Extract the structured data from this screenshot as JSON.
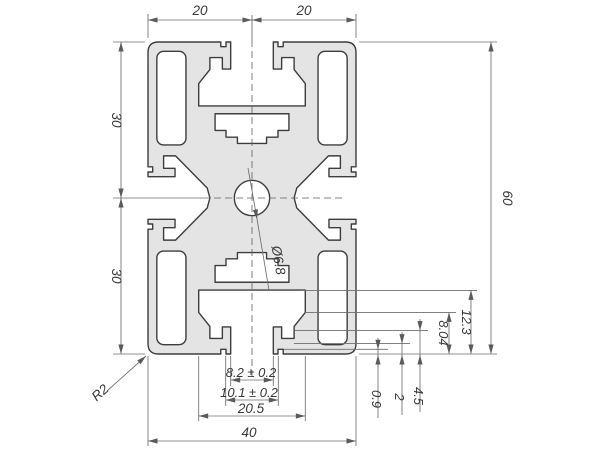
{
  "drawing": {
    "title": "Aluminium extrusion profile 40x60 cross-section, dimensioned technical drawing",
    "dims": {
      "top_left": "20",
      "top_right": "20",
      "left_upper": "30",
      "left_lower": "30",
      "height": "60",
      "stack_outer": "12.3",
      "stack_inner": "8.04",
      "lip_a": "4.5",
      "lip_b": "2",
      "lip_c": "0.9",
      "slot_opening": "8.2 ± 0.2",
      "slot_undercut": "10.1 ± 0.2",
      "slot_chamber": "20.5",
      "width": "40",
      "hole": "Ø6.8",
      "fillet": "R2"
    },
    "colors": {
      "profile_fill": "#e4e4e4",
      "outline": "#3d3d3d",
      "dim_line": "#6e6e6e",
      "text": "#383838"
    }
  }
}
